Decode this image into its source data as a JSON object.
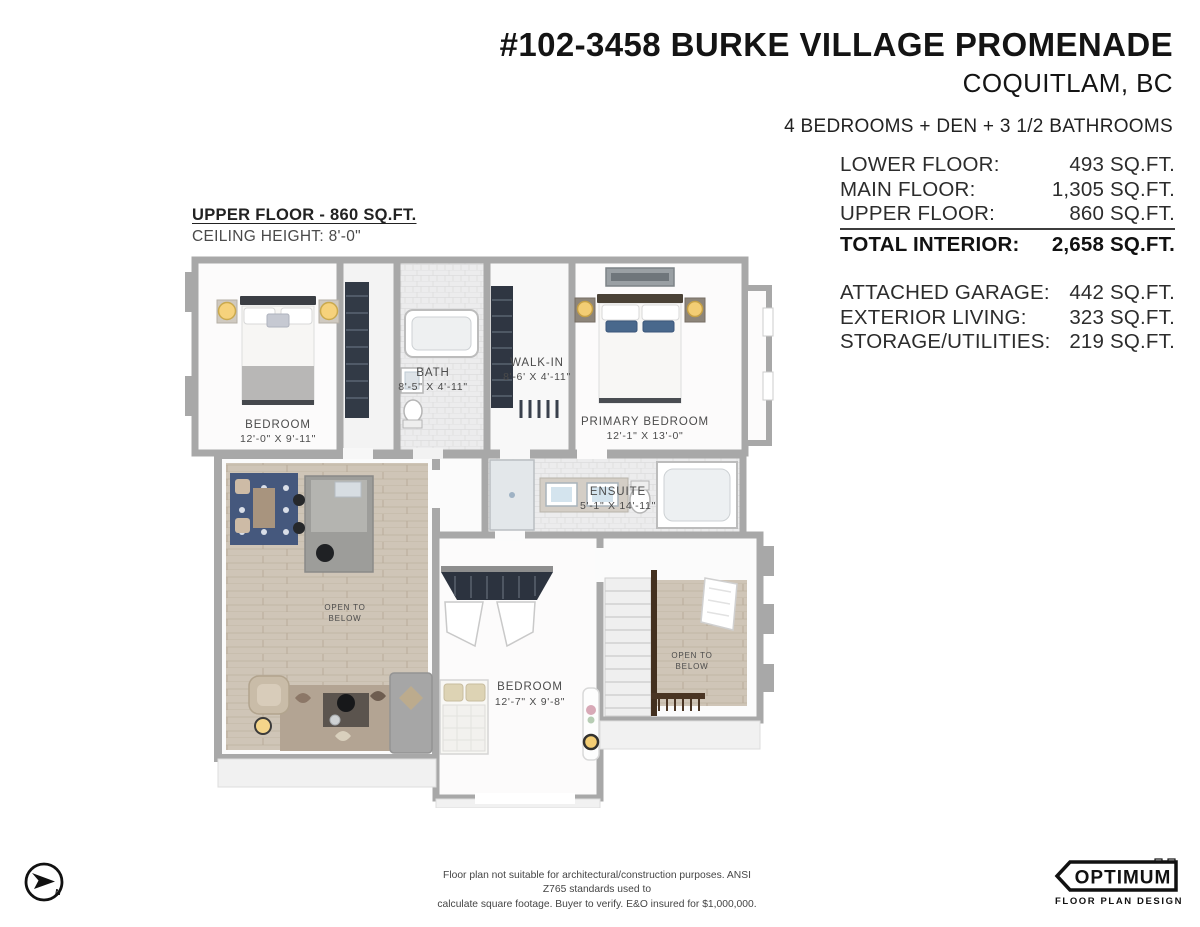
{
  "header": {
    "title": "#102-3458 BURKE VILLAGE PROMENADE",
    "city": "COQUITLAM, BC",
    "configuration": "4 BEDROOMS + DEN + 3 1/2 BATHROOMS"
  },
  "floor_label": {
    "title": "UPPER FLOOR - 860 SQ.FT.",
    "ceiling_height": "CEILING HEIGHT: 8'-0\""
  },
  "area_summary": {
    "rows": [
      {
        "label": "LOWER FLOOR:",
        "value": "493 SQ.FT."
      },
      {
        "label": "MAIN FLOOR:",
        "value": "1,305 SQ.FT."
      },
      {
        "label": "UPPER FLOOR:",
        "value": "860 SQ.FT."
      },
      {
        "label": "TOTAL INTERIOR:",
        "value": "2,658 SQ.FT."
      }
    ],
    "secondary_rows": [
      {
        "label": "ATTACHED GARAGE:",
        "value": "442 SQ.FT."
      },
      {
        "label": "EXTERIOR LIVING:",
        "value": "323 SQ.FT."
      },
      {
        "label": "STORAGE/UTILITIES:",
        "value": "219 SQ.FT."
      }
    ]
  },
  "rooms": {
    "bedroom_left": {
      "name": "BEDROOM",
      "dims": "12'-0\" X 9'-11\""
    },
    "bath": {
      "name": "BATH",
      "dims": "8'-5\" X 4'-11\""
    },
    "walk_in": {
      "name": "WALK-IN",
      "dims": "8'-6' X 4'-11\""
    },
    "primary_bedroom": {
      "name": "PRIMARY BEDROOM",
      "dims": "12'-1\" X 13'-0\""
    },
    "ensuite": {
      "name": "ENSUITE",
      "dims": "5'-1\" X 14'-11\""
    },
    "bedroom_lower": {
      "name": "BEDROOM",
      "dims": "12'-7\" X 9'-8\""
    },
    "open_to_below": {
      "line1": "OPEN TO",
      "line2": "BELOW"
    }
  },
  "footer": {
    "disclaimer_line1": "Floor plan not suitable for architectural/construction purposes. ANSI Z765 standards used to",
    "disclaimer_line2": "calculate square footage. Buyer to verify.  E&O insured for $1,000,000.",
    "compass_label": "N"
  },
  "logo": {
    "brand": "OPTIMUM",
    "tagline": "FLOOR PLAN DESIGNS"
  },
  "colors": {
    "wall": "#a8a8a8",
    "wood_floor": "#cfc5b7",
    "accent_blue": "#49688c",
    "lamp_glow": "#f3cd74",
    "text_dark": "#141414",
    "label_gray": "#4b4b4b"
  }
}
